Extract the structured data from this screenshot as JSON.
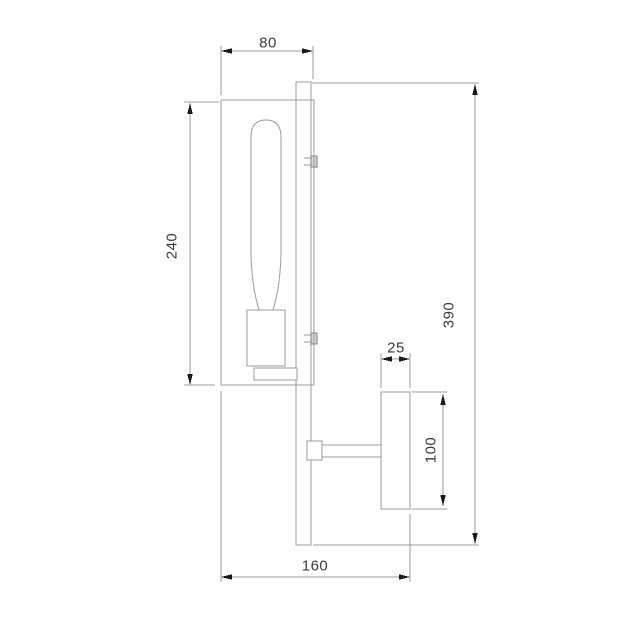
{
  "figure": {
    "title": "",
    "type": "technical-dimension-drawing"
  },
  "colors": {
    "background": "#ffffff",
    "outline": "#9b9b9b",
    "arrow": "#1a1a1a",
    "text": "#3a3a3a",
    "clip_fill": "#d6d6d6"
  },
  "dimensions": {
    "shade_depth": {
      "label": "80"
    },
    "shade_height": {
      "label": "240"
    },
    "total_height": {
      "label": "390"
    },
    "backplate_depth": {
      "label": "25"
    },
    "backplate_height": {
      "label": "100"
    },
    "total_depth": {
      "label": "160"
    }
  }
}
